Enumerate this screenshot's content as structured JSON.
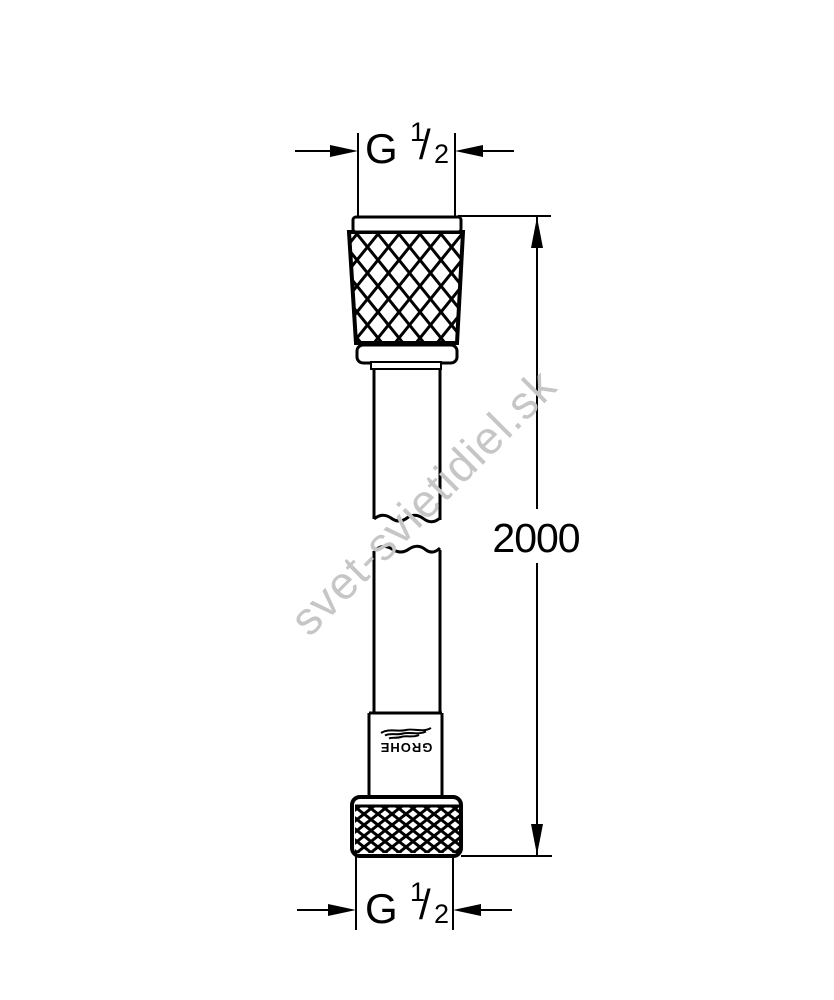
{
  "diagram": {
    "top_dimension": {
      "thread_letter": "G",
      "fraction_numerator": "1",
      "fraction_denominator": "2"
    },
    "bottom_dimension": {
      "thread_letter": "G",
      "fraction_numerator": "1",
      "fraction_denominator": "2"
    },
    "length_dimension": {
      "value": "2000"
    },
    "logo": {
      "text": "GROHE"
    },
    "watermark": {
      "text": "svet-svietidiel.sk"
    },
    "colors": {
      "line": "#000000",
      "watermark": "#c6c6c6",
      "background": "#ffffff"
    }
  }
}
